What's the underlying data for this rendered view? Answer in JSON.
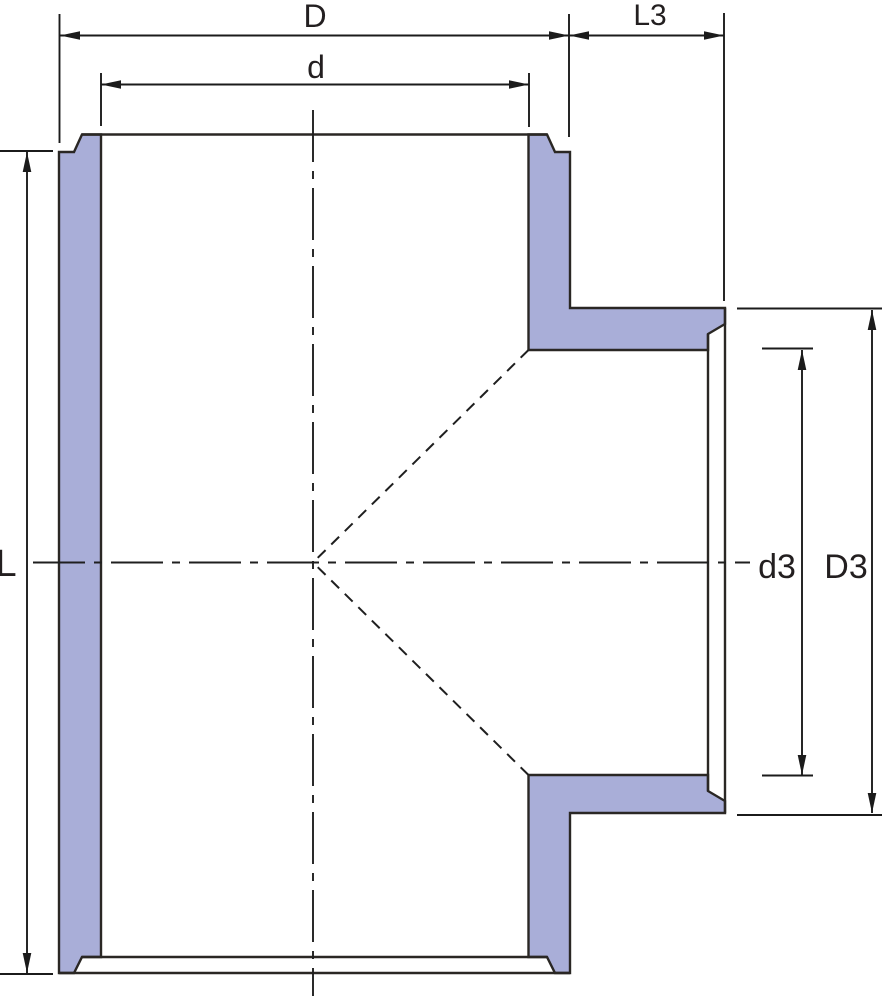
{
  "drawing": {
    "kind": "pipe-tee-socket-cross-section",
    "labels": {
      "body_outer_width": "D",
      "body_bore_width": "d",
      "branch_length": "L3",
      "body_length": "L",
      "branch_bore": "d3",
      "branch_outer": "D3"
    },
    "colors": {
      "wall_fill": "#a9aed8",
      "outline": "#2a2724",
      "dimension_line": "#1b1b1b",
      "label_text": "#231f20",
      "background": "#ffffff"
    }
  }
}
